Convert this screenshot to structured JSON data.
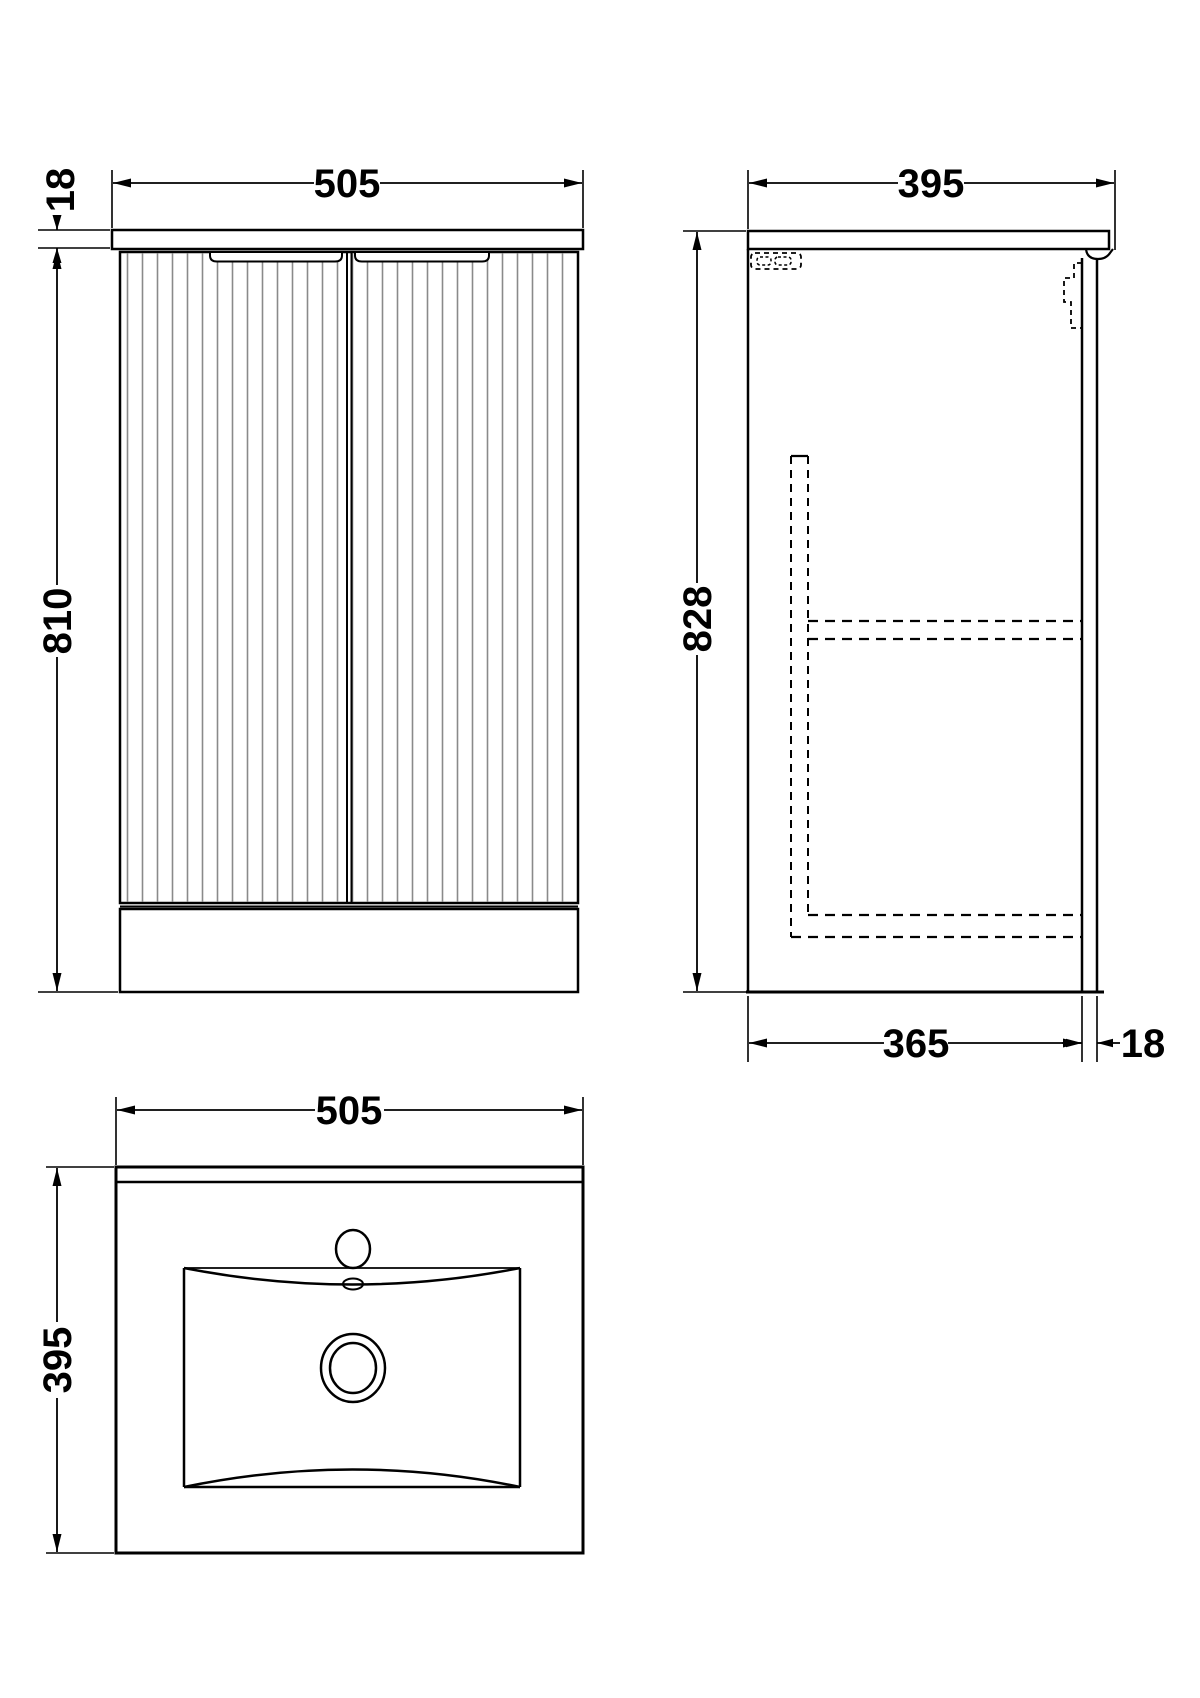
{
  "drawing": {
    "views": {
      "front": {
        "width": "505",
        "worktop_thickness": "18",
        "cabinet_height": "810"
      },
      "side": {
        "depth": "395",
        "overall_height": "828",
        "carcass_depth": "365",
        "door_thickness": "18"
      },
      "plan": {
        "width": "505",
        "depth": "395"
      }
    }
  }
}
